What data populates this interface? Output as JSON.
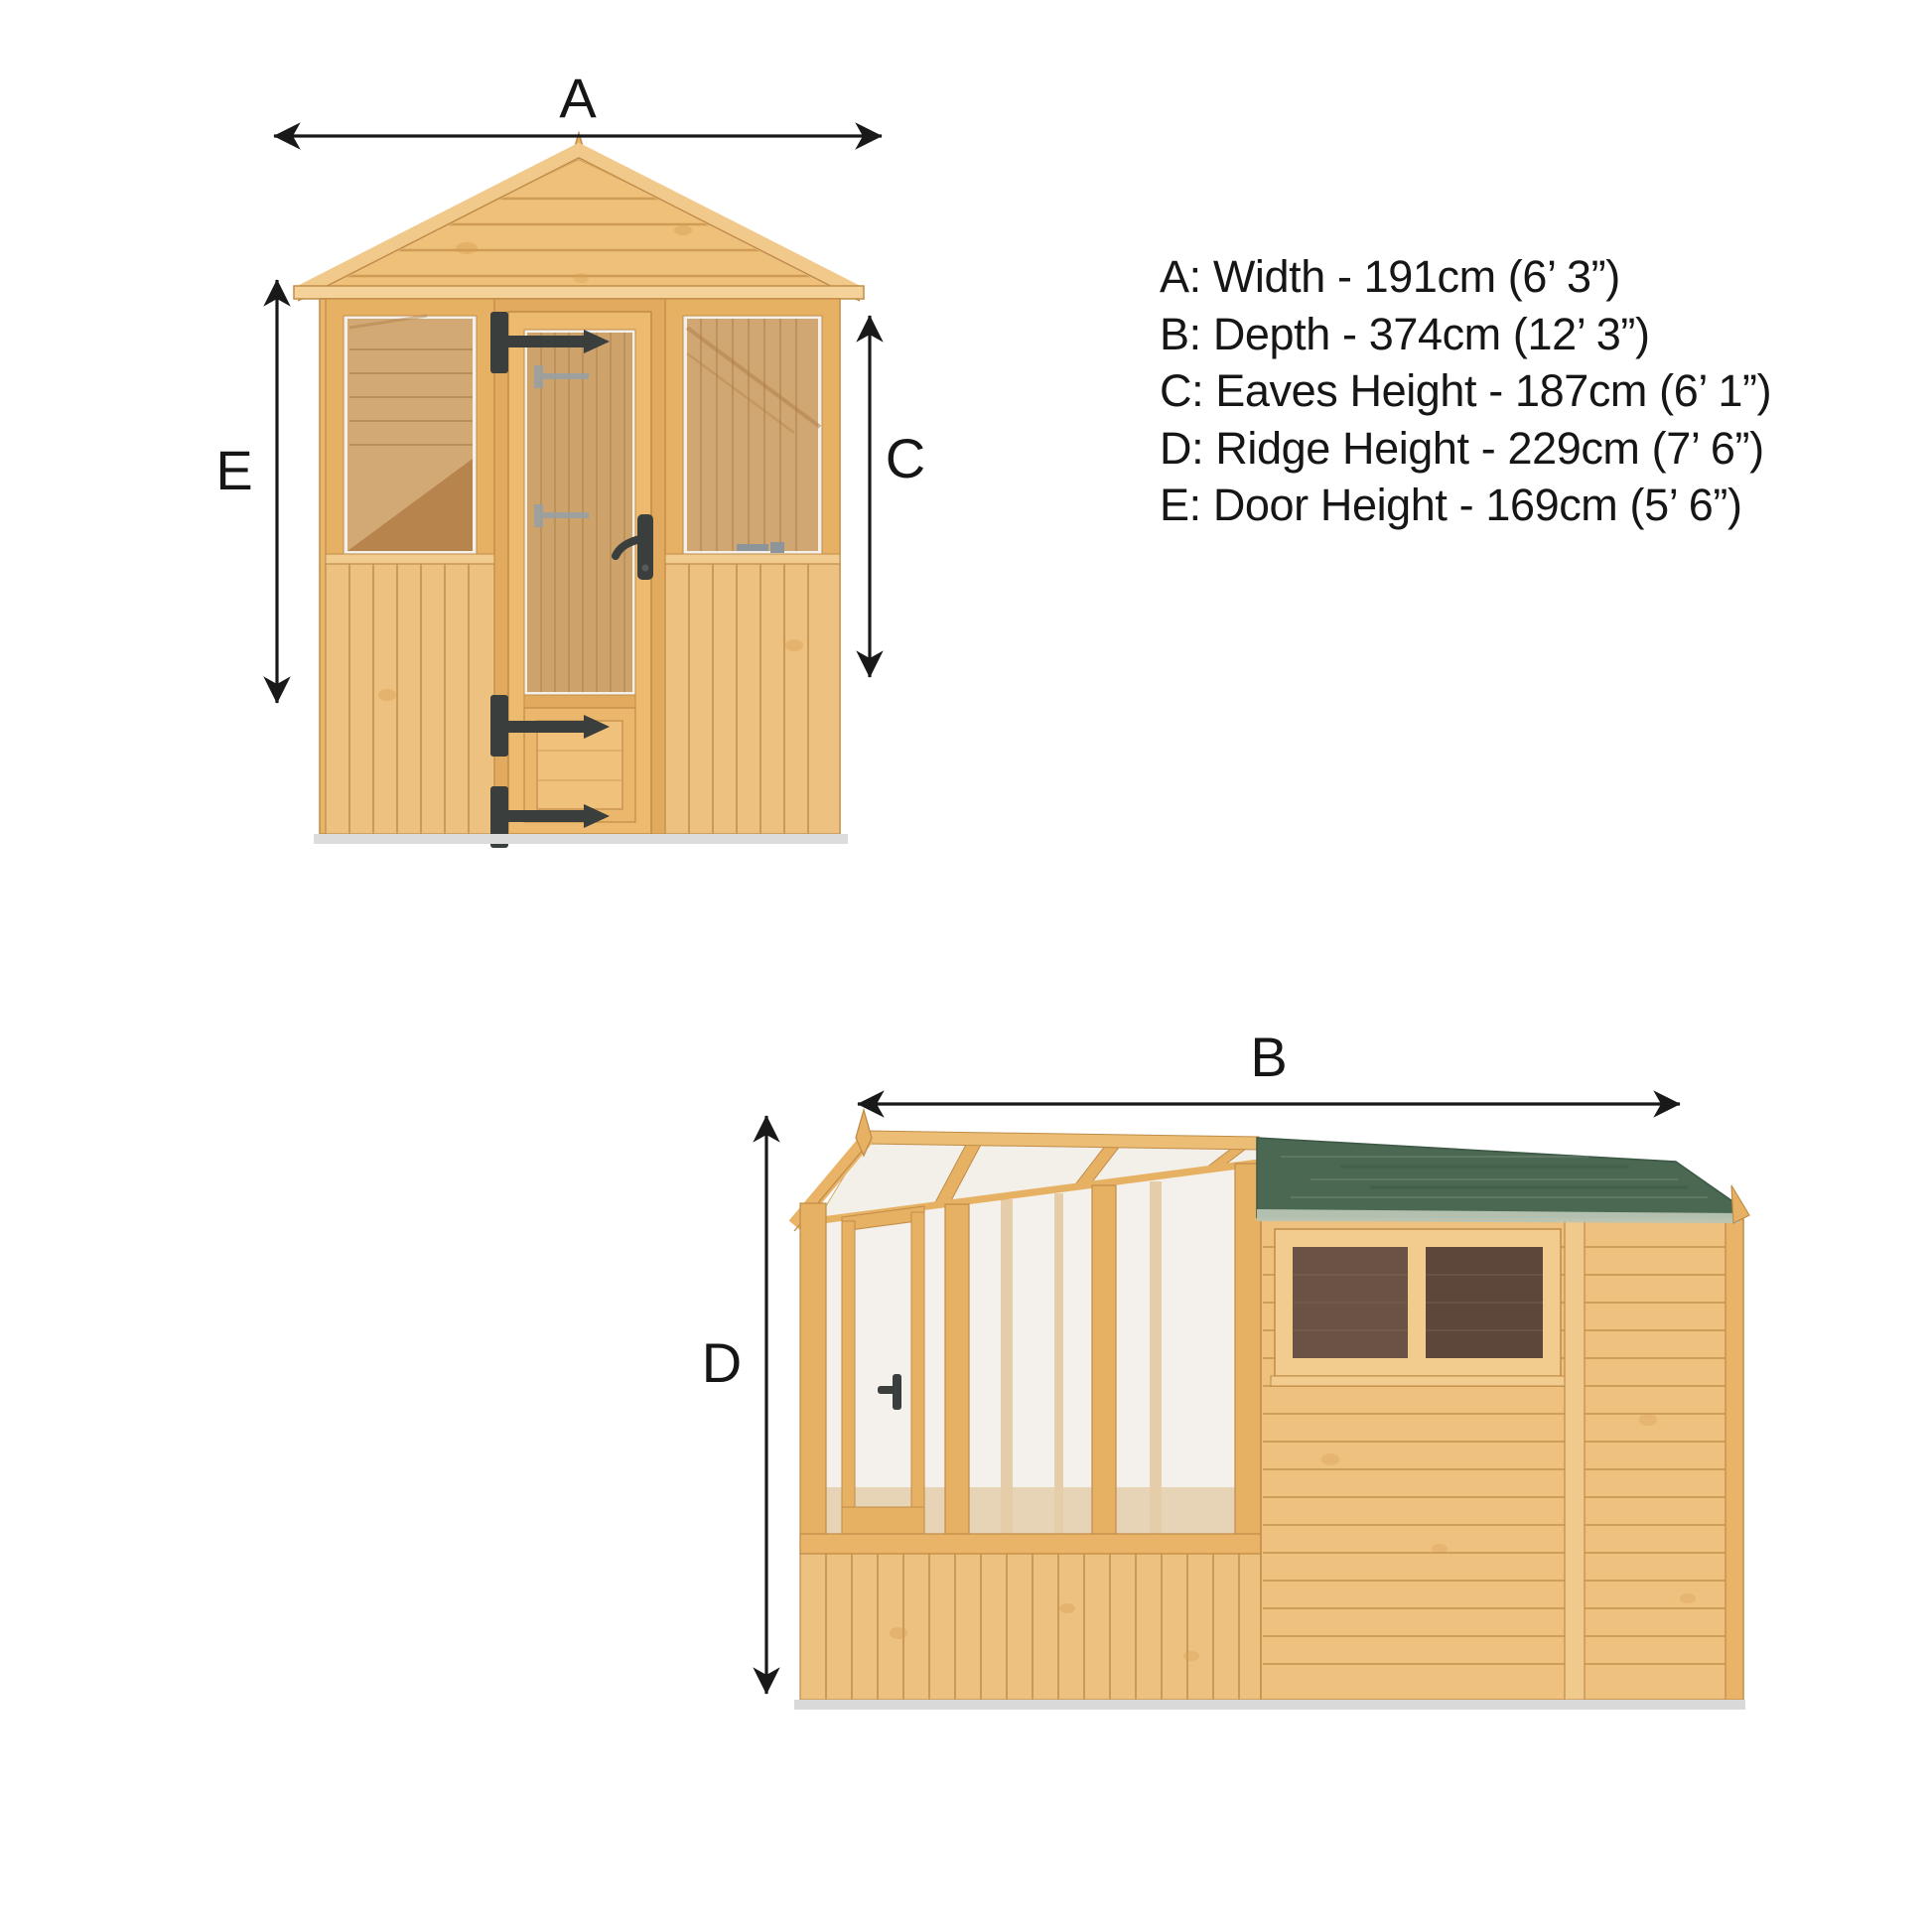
{
  "legend": {
    "lines": [
      "A: Width - 191cm (6’ 3”)",
      "B: Depth - 374cm (12’ 3”)",
      "C: Eaves Height - 187cm (6’ 1”)",
      "D: Ridge Height - 229cm (7’ 6”)",
      "E: Door Height - 169cm (5’ 6”)"
    ],
    "entries": [
      {
        "letter": "A",
        "dimension": "Width",
        "metric": "191cm",
        "imperial": "6’ 3”"
      },
      {
        "letter": "B",
        "dimension": "Depth",
        "metric": "374cm",
        "imperial": "12’ 3”"
      },
      {
        "letter": "C",
        "dimension": "Eaves Height",
        "metric": "187cm",
        "imperial": "6’ 1”"
      },
      {
        "letter": "D",
        "dimension": "Ridge Height",
        "metric": "229cm",
        "imperial": "7’ 6”"
      },
      {
        "letter": "E",
        "dimension": "Door Height",
        "metric": "169cm",
        "imperial": "5’ 6”"
      }
    ]
  },
  "front_view": {
    "arrow_labels": {
      "width": "A",
      "door_height": "E",
      "eaves_height": "C"
    }
  },
  "side_view": {
    "arrow_labels": {
      "depth": "B",
      "ridge_height": "D"
    }
  },
  "colors": {
    "background": "#ffffff",
    "wood_light": "#f2cb8e",
    "wood_mid": "#e8b569",
    "wood_outline": "#c08c47",
    "wood_groove": "#c6954f",
    "glass": "#f4f1ec",
    "interior_wood": "#cb9c60",
    "roof_felt_green": "#4b6853",
    "roof_felt_edge": "#b8c5b5",
    "window_pane_left": "#6a5244",
    "window_pane_right": "#5c473a",
    "hardware_black": "#3a3e3d",
    "hardware_silver": "#9aa0a4",
    "dimension_line": "#191919",
    "shadow": "#d9d9d9"
  }
}
